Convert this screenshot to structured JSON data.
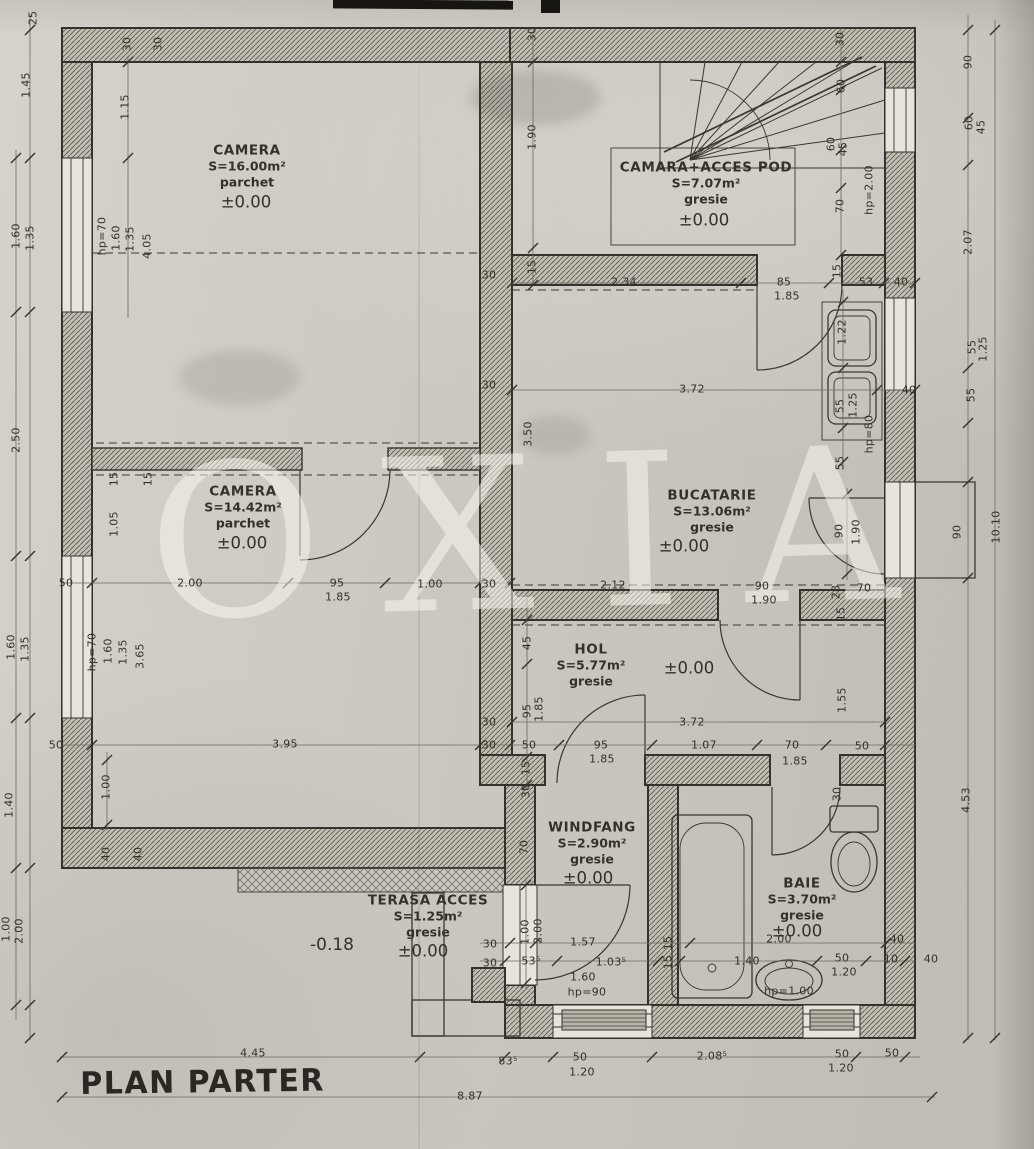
{
  "meta": {
    "title": "PLAN PARTER",
    "watermark": "OXIA"
  },
  "colors": {
    "paper": "#d1cdc5",
    "ink": "#34312b",
    "dim_text": "#33302a",
    "watermark_color": "rgba(249,247,242,0.52)"
  },
  "outside": {
    "text": "-0.18"
  },
  "rooms": [
    {
      "name": "CAMERA",
      "area": "S=16.00m²",
      "floor": "parchet",
      "level": "±0.00",
      "x": 247,
      "y": 166,
      "lx": 246,
      "ly": 202
    },
    {
      "name": "CAMARA+ACCES POD",
      "area": "S=7.07m²",
      "floor": "gresie",
      "level": "±0.00",
      "x": 706,
      "y": 183,
      "lx": 704,
      "ly": 220
    },
    {
      "name": "CAMERA",
      "area": "S=14.42m²",
      "floor": "parchet",
      "level": "±0.00",
      "x": 243,
      "y": 507,
      "lx": 242,
      "ly": 543
    },
    {
      "name": "BUCATARIE",
      "area": "S=13.06m²",
      "floor": "gresie",
      "level": "±0.00",
      "x": 712,
      "y": 511,
      "lx": 684,
      "ly": 546
    },
    {
      "name": "HOL",
      "area": "S=5.77m²",
      "floor": "gresie",
      "level": "±0.00",
      "x": 591,
      "y": 665,
      "lx": 689,
      "ly": 668
    },
    {
      "name": "WINDFANG",
      "area": "S=2.90m²",
      "floor": "gresie",
      "level": "±0.00",
      "x": 592,
      "y": 843,
      "lx": 588,
      "ly": 878
    },
    {
      "name": "BAIE",
      "area": "S=3.70m²",
      "floor": "gresie",
      "level": "±0.00",
      "x": 802,
      "y": 899,
      "lx": 797,
      "ly": 931
    },
    {
      "name": "TERASA ACCES",
      "area": "S=1.25m²",
      "floor": "gresie",
      "level": "±0.00",
      "x": 428,
      "y": 916,
      "lx": 423,
      "ly": 951
    }
  ],
  "dims": [
    [
      "30",
      127,
      44,
      -90
    ],
    [
      "30",
      158,
      44,
      -90
    ],
    [
      "25",
      33,
      18,
      -90
    ],
    [
      "1.45",
      26,
      85,
      -90
    ],
    [
      "1.60",
      16,
      236,
      -90
    ],
    [
      "1.35",
      30,
      238,
      -90
    ],
    [
      "2.50",
      16,
      440,
      -90
    ],
    [
      "1.60",
      11,
      647,
      -90
    ],
    [
      "1.35",
      25,
      649,
      -90
    ],
    [
      "1.40",
      9,
      805,
      -90
    ],
    [
      "1.00",
      6,
      929,
      -90
    ],
    [
      "2.00",
      19,
      931,
      -90
    ],
    [
      "1.15",
      125,
      107,
      -90
    ],
    [
      "hp=70",
      102,
      236,
      -90
    ],
    [
      "1.60",
      116,
      238,
      -90
    ],
    [
      "1.35",
      130,
      239,
      -90
    ],
    [
      "4.05",
      147,
      246,
      -90
    ],
    [
      "15",
      114,
      479,
      -90
    ],
    [
      "15",
      148,
      479,
      -90
    ],
    [
      "1.05",
      114,
      524,
      -90
    ],
    [
      "50",
      66,
      583,
      0
    ],
    [
      "2.00",
      190,
      583,
      0
    ],
    [
      "95",
      337,
      583,
      0
    ],
    [
      "1.85",
      338,
      597,
      0
    ],
    [
      "1.00",
      430,
      584,
      0
    ],
    [
      "30",
      489,
      584,
      0
    ],
    [
      "2.12",
      613,
      585,
      0
    ],
    [
      "90",
      762,
      586,
      0
    ],
    [
      "1.90",
      764,
      600,
      0
    ],
    [
      "28",
      836,
      592,
      -90
    ],
    [
      "15",
      841,
      614,
      -90
    ],
    [
      "70",
      864,
      588,
      0
    ],
    [
      "hp=70",
      92,
      652,
      -90
    ],
    [
      "1.60",
      108,
      651,
      -90
    ],
    [
      "1.35",
      123,
      652,
      -90
    ],
    [
      "3.65",
      140,
      656,
      -90
    ],
    [
      "3.95",
      285,
      744,
      0
    ],
    [
      "1.00",
      106,
      787,
      -90
    ],
    [
      "40",
      106,
      854,
      -90
    ],
    [
      "40",
      138,
      854,
      -90
    ],
    [
      "50",
      56,
      745,
      0
    ],
    [
      "45",
      527,
      643,
      -90
    ],
    [
      "95",
      527,
      711,
      -90
    ],
    [
      "1.85",
      539,
      709,
      -90
    ],
    [
      "30",
      489,
      722,
      0
    ],
    [
      "30",
      489,
      745,
      0
    ],
    [
      "50",
      529,
      745,
      0
    ],
    [
      "3.72",
      692,
      722,
      0
    ],
    [
      "95",
      601,
      745,
      0
    ],
    [
      "1.85",
      602,
      759,
      0
    ],
    [
      "1.07",
      704,
      745,
      0
    ],
    [
      "70",
      792,
      745,
      0
    ],
    [
      "1.85",
      795,
      761,
      0
    ],
    [
      "50",
      862,
      746,
      0
    ],
    [
      "15",
      526,
      768,
      -90
    ],
    [
      "30",
      526,
      791,
      -90
    ],
    [
      "1.55",
      842,
      700,
      -90
    ],
    [
      "3.50",
      528,
      434,
      -90
    ],
    [
      "3.72",
      692,
      389,
      0
    ],
    [
      "30",
      489,
      385,
      0
    ],
    [
      "55",
      840,
      406,
      -90
    ],
    [
      "1.25",
      853,
      405,
      -90
    ],
    [
      "hp=80",
      869,
      434,
      -90
    ],
    [
      "55",
      840,
      463,
      -90
    ],
    [
      "1.22",
      842,
      332,
      -90
    ],
    [
      "40",
      909,
      390,
      0
    ],
    [
      "15",
      837,
      271,
      -90
    ],
    [
      "53",
      866,
      282,
      0
    ],
    [
      "40",
      901,
      282,
      0
    ],
    [
      "85",
      784,
      282,
      0
    ],
    [
      "1.85",
      787,
      296,
      0
    ],
    [
      "2.34",
      624,
      282,
      0
    ],
    [
      "15",
      532,
      267,
      -90
    ],
    [
      "30",
      489,
      275,
      0
    ],
    [
      "30",
      532,
      34,
      -90
    ],
    [
      "1.90",
      532,
      137,
      -90
    ],
    [
      "30",
      840,
      39,
      -90
    ],
    [
      "60",
      841,
      86,
      -90
    ],
    [
      "60",
      831,
      144,
      -90
    ],
    [
      "45",
      843,
      149,
      -90
    ],
    [
      "70",
      840,
      206,
      -90
    ],
    [
      "hp=2.00",
      869,
      190,
      -90
    ],
    [
      "90",
      968,
      62,
      -90
    ],
    [
      "60",
      969,
      123,
      -90
    ],
    [
      "45",
      981,
      127,
      -90
    ],
    [
      "2.07",
      968,
      242,
      -90
    ],
    [
      "55",
      972,
      347,
      -90
    ],
    [
      "1.25",
      983,
      349,
      -90
    ],
    [
      "55",
      971,
      395,
      -90
    ],
    [
      "90",
      957,
      532,
      -90
    ],
    [
      "10.10",
      996,
      527,
      -90
    ],
    [
      "4.53",
      966,
      800,
      -90
    ],
    [
      "90",
      839,
      531,
      -90
    ],
    [
      "1.90",
      856,
      532,
      -90
    ],
    [
      "70",
      524,
      847,
      -90
    ],
    [
      "30",
      490,
      944,
      0
    ],
    [
      "30",
      490,
      963,
      0
    ],
    [
      "53⁵",
      531,
      961,
      0
    ],
    [
      "1.00",
      525,
      932,
      -90
    ],
    [
      "2.00",
      538,
      931,
      -90
    ],
    [
      "1.57",
      583,
      942,
      0
    ],
    [
      "1.03⁵",
      611,
      962,
      0
    ],
    [
      "1.60",
      583,
      977,
      0
    ],
    [
      "hp=90",
      587,
      992,
      0
    ],
    [
      "15",
      668,
      943,
      -90
    ],
    [
      "15",
      668,
      962,
      -90
    ],
    [
      "2.00",
      779,
      939,
      0
    ],
    [
      "1.40",
      747,
      961,
      0
    ],
    [
      "50",
      842,
      958,
      0
    ],
    [
      "1.20",
      844,
      972,
      0
    ],
    [
      "hp=1.00",
      789,
      991,
      0
    ],
    [
      "40",
      897,
      939,
      0
    ],
    [
      "10",
      891,
      959,
      0
    ],
    [
      "40",
      931,
      959,
      0
    ],
    [
      "30",
      837,
      794,
      -90
    ],
    [
      "4.45",
      253,
      1053,
      0
    ],
    [
      "83⁵",
      508,
      1061,
      0
    ],
    [
      "50",
      580,
      1057,
      0
    ],
    [
      "1.20",
      582,
      1072,
      0
    ],
    [
      "2.08⁵",
      712,
      1056,
      0
    ],
    [
      "50",
      842,
      1054,
      0
    ],
    [
      "1.20",
      841,
      1068,
      0
    ],
    [
      "50",
      892,
      1053,
      0
    ],
    [
      "8.87",
      470,
      1096,
      0
    ]
  ]
}
